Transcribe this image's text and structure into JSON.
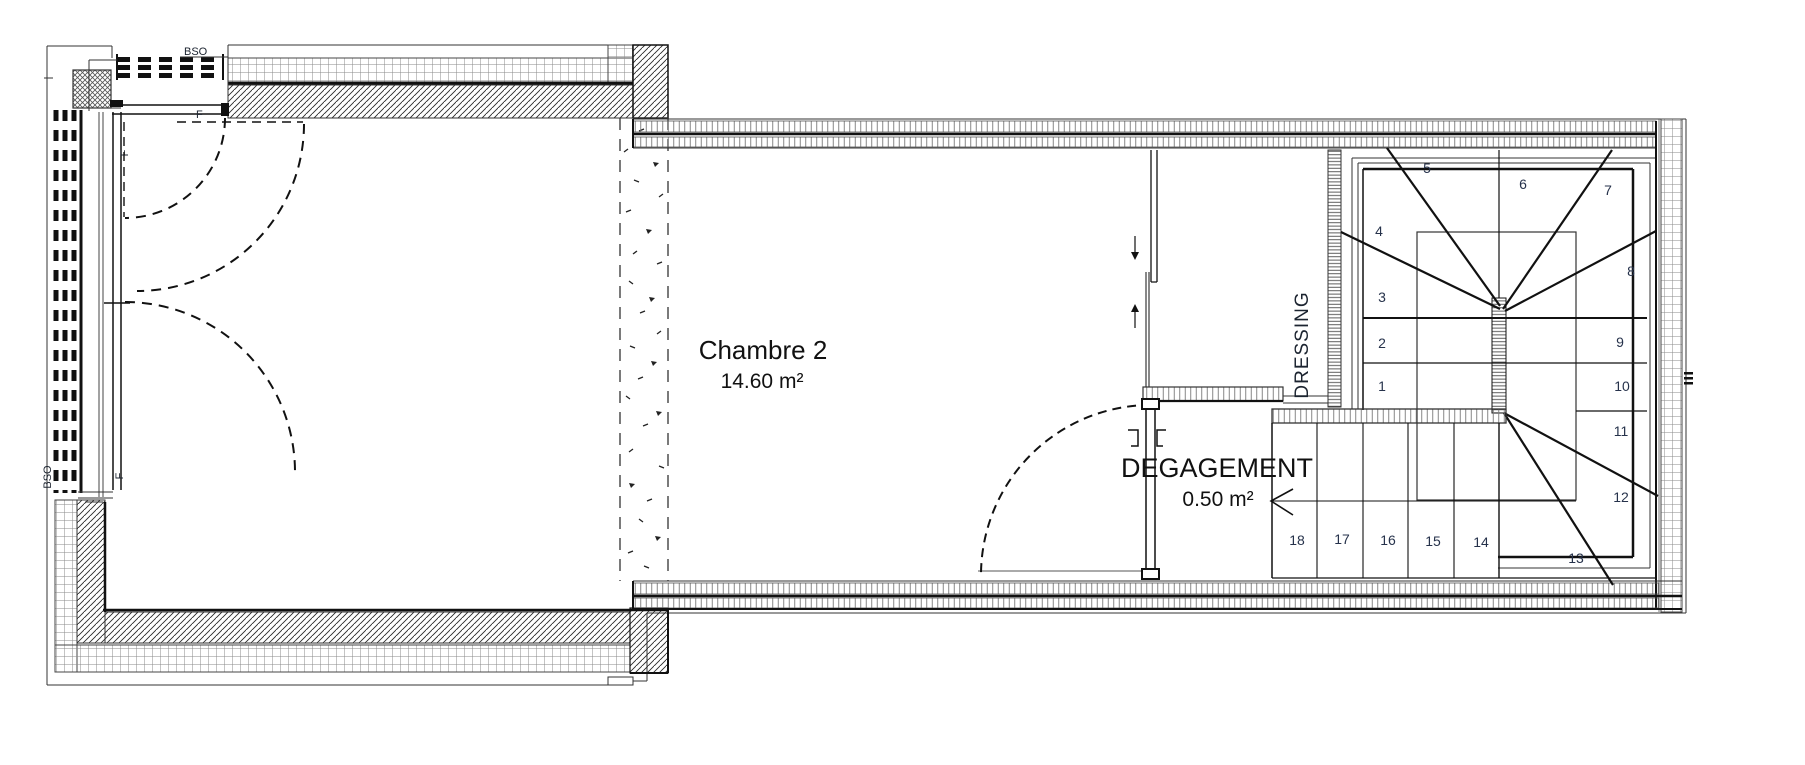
{
  "plan": {
    "rooms": {
      "chambre2": {
        "name": "Chambre 2",
        "area": "14.60 m²"
      },
      "degagement": {
        "name": "DEGAGEMENT",
        "area": "0.50 m²"
      },
      "dressing": {
        "name": "DRESSING"
      }
    },
    "annotations": {
      "bso_top": "BSO",
      "bso_left": "BSO",
      "f_top": "F",
      "f_left_upper": "F",
      "f_left_lower": "F"
    },
    "stairs": {
      "steps": [
        "1",
        "2",
        "3",
        "4",
        "5",
        "6",
        "7",
        "8",
        "9",
        "10",
        "11",
        "12",
        "13",
        "14",
        "15",
        "16",
        "17",
        "18"
      ]
    },
    "colors": {
      "line": "#1a1a1a",
      "hatch_gray": "#8a8a8a",
      "number": "#26324b",
      "text": "#111111",
      "background": "#ffffff"
    }
  }
}
